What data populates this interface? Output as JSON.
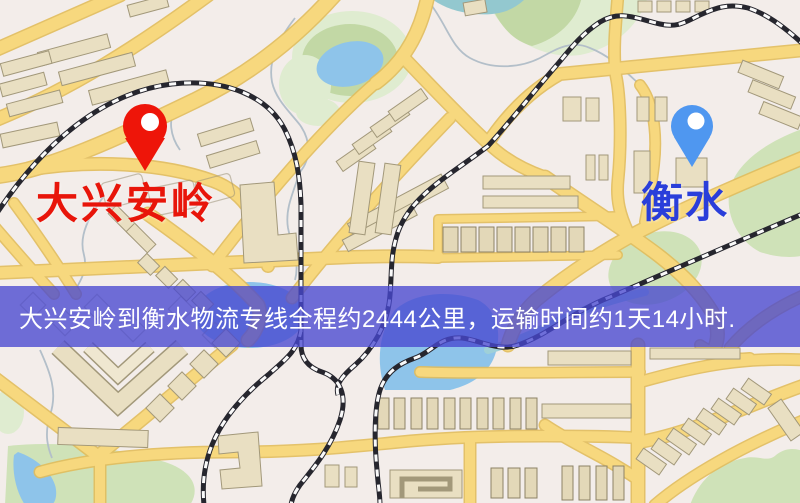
{
  "banner": {
    "text": "大兴安岭到衡水物流专线全程约2444公里，运输时间约1天14小时.",
    "distance_km": "2444",
    "duration": "1天14小时"
  },
  "map": {
    "origin": {
      "name": "大兴安岭"
    },
    "destination": {
      "name": "衡水"
    }
  },
  "colors": {
    "banner-bg": "rgba(72,72,208,0.78)",
    "banner-text": "#ffffff",
    "origin-color": "#e8150a",
    "dest-color": "#2a3eda",
    "pin-origin": "#ee1509",
    "pin-dest": "#4f97f0",
    "bg": "#f3edea"
  }
}
